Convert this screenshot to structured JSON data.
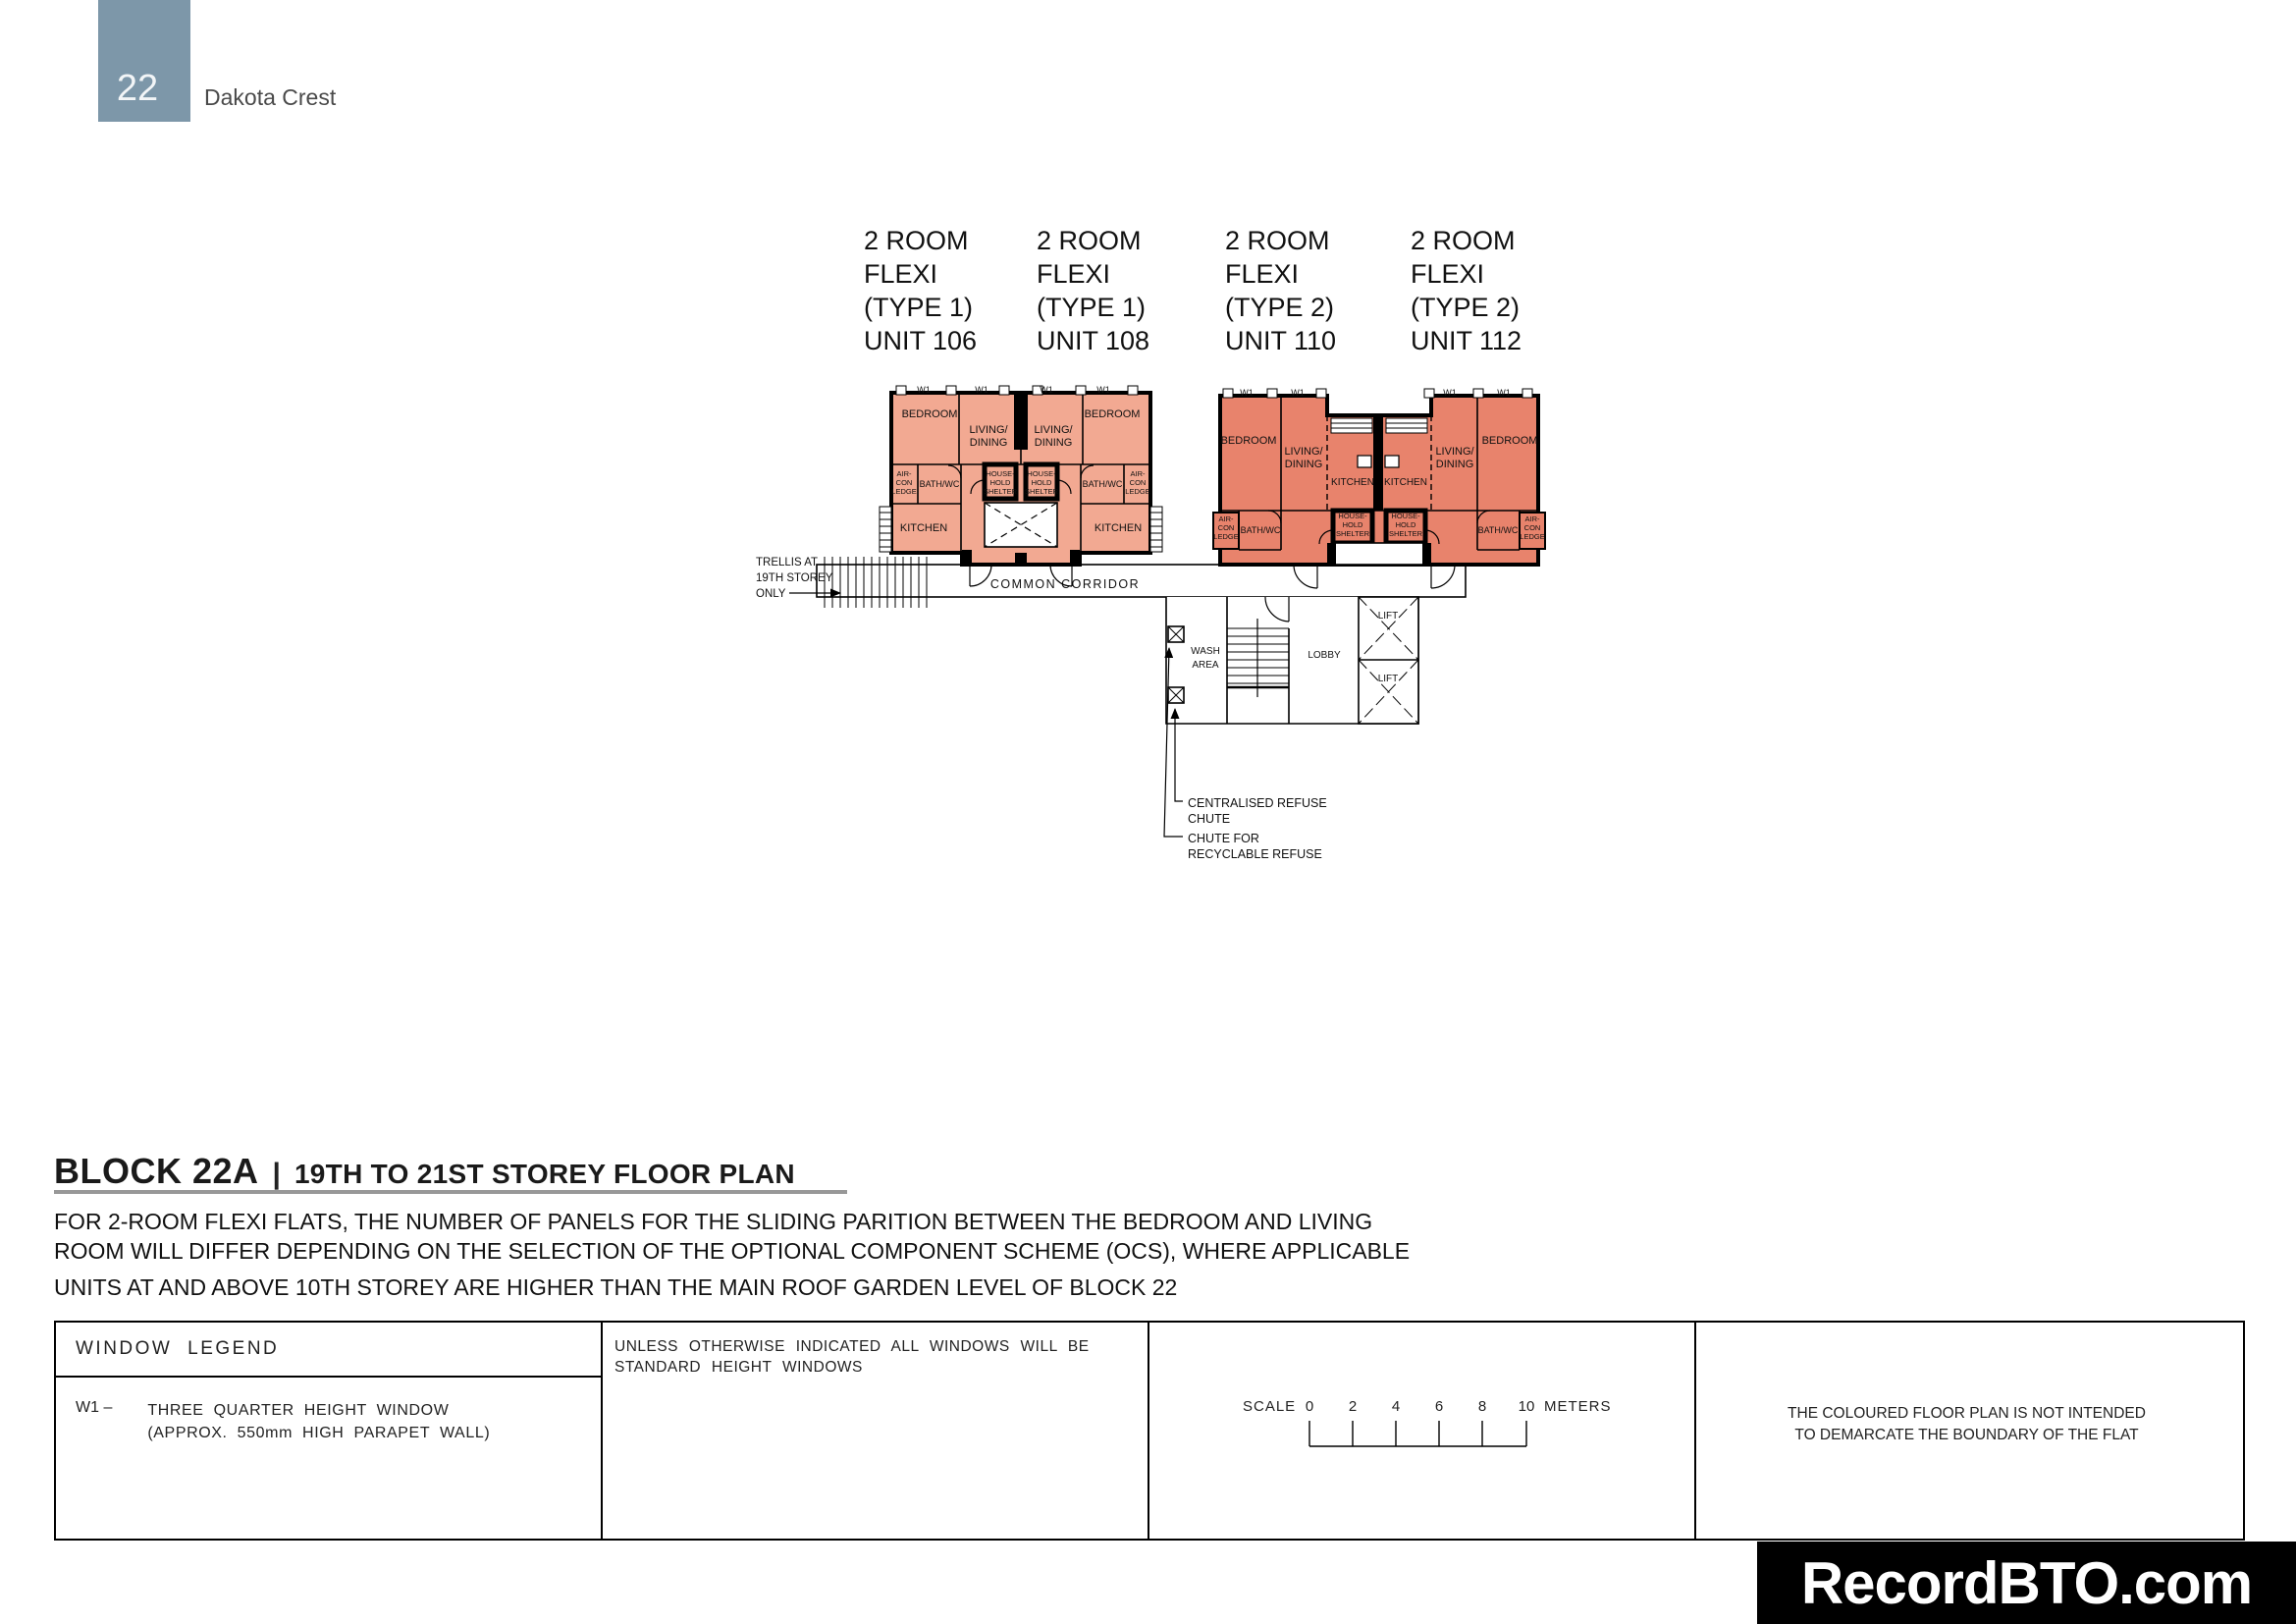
{
  "header": {
    "page_number": "22",
    "project_name": "Dakota Crest"
  },
  "units": [
    {
      "lines": [
        "2 ROOM",
        "FLEXI",
        "(TYPE 1)",
        "UNIT 106"
      ]
    },
    {
      "lines": [
        "2 ROOM",
        "FLEXI",
        "(TYPE 1)",
        "UNIT 108"
      ]
    },
    {
      "lines": [
        "2 ROOM",
        "FLEXI",
        "(TYPE 2)",
        "UNIT 110"
      ]
    },
    {
      "lines": [
        "2 ROOM",
        "FLEXI",
        "(TYPE 2)",
        "UNIT 112"
      ]
    }
  ],
  "plan": {
    "w1": "W1",
    "bedroom": "BEDROOM",
    "living1": "LIVING/",
    "living2": "DINING",
    "aircon1": "AIR-",
    "aircon2": "CON",
    "aircon3": "LEDGE",
    "bath": "BATH/WC",
    "hhs1": "HOUSE-",
    "hhs2": "HOLD",
    "hhs3": "SHELTER",
    "kitchen": "KITCHEN",
    "corridor": "COMMON CORRIDOR",
    "trellis1": "TRELLIS AT",
    "trellis2": "19TH STOREY",
    "trellis3": "ONLY",
    "wash1": "WASH",
    "wash2": "AREA",
    "lobby": "LOBBY",
    "lift": "LIFT",
    "chute1a": "CENTRALISED REFUSE",
    "chute1b": "CHUTE",
    "chute2a": "CHUTE FOR",
    "chute2b": "RECYCLABLE REFUSE"
  },
  "title": {
    "block": "BLOCK 22A",
    "separator": "|",
    "subtitle": "19TH TO 21ST STOREY FLOOR PLAN"
  },
  "notes": [
    "FOR 2-ROOM FLEXI FLATS, THE NUMBER OF PANELS FOR THE SLIDING PARITION BETWEEN THE BEDROOM AND LIVING",
    "ROOM WILL DIFFER DEPENDING ON THE SELECTION OF THE OPTIONAL COMPONENT SCHEME (OCS), WHERE APPLICABLE",
    "UNITS AT AND ABOVE 10TH STOREY ARE HIGHER THAN THE MAIN ROOF GARDEN LEVEL OF BLOCK 22"
  ],
  "legend": {
    "header": "WINDOW LEGEND",
    "w1_code": "W1  –",
    "w1_desc1": "THREE QUARTER HEIGHT WINDOW",
    "w1_desc2": "(APPROX. 550mm HIGH PARAPET WALL)",
    "windows_note1": "UNLESS OTHERWISE INDICATED ALL WINDOWS WILL BE",
    "windows_note2": "STANDARD HEIGHT WINDOWS"
  },
  "scalebar": {
    "label": "SCALE",
    "ticks": [
      "0",
      "2",
      "4",
      "6",
      "8",
      "10"
    ],
    "unit": "METERS"
  },
  "disclaimer": {
    "line1": "THE COLOURED FLOOR PLAN IS NOT INTENDED",
    "line2": "TO DEMARCATE THE BOUNDARY OF THE FLAT"
  },
  "watermark": {
    "text": "RecordBTO.com"
  },
  "colors": {
    "header_box": "#7d97a9",
    "type1_fill": "#f2a992",
    "type2_fill": "#e8836c",
    "title_underline": "#989898",
    "watermark_bg": "#000000",
    "watermark_text": "#ffffff"
  }
}
